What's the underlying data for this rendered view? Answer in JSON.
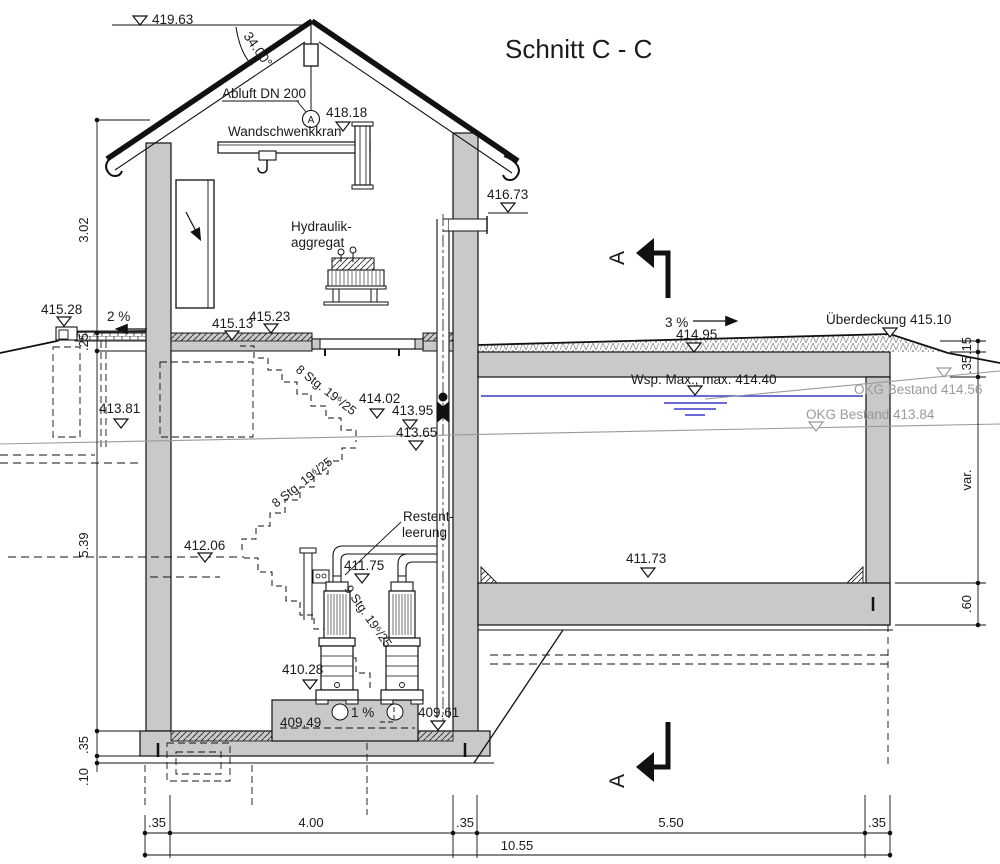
{
  "title": "Schnitt C - C",
  "section_marker": "A",
  "roof": {
    "ridge_level": "419.63",
    "angle": "34.00°",
    "vent_label": "Abluft DN 200",
    "vent_symbol": "A",
    "crane_level": "418.18",
    "crane_label": "Wandschwenkkran"
  },
  "room": {
    "hydraulic1": "Hydraulik-",
    "hydraulic2": "aggregat",
    "pipe_level": "416.73"
  },
  "left": {
    "ext_level": "415.28",
    "slope": "2 %",
    "floor_level": "415.13",
    "cover_level": "415.23",
    "drain_level": "413.81"
  },
  "stairs": {
    "flight1": "8 Stg. 19⁶/25",
    "flight2": "8 Stg. 19⁶/25",
    "flight3": "9 Stg. 19⁶/25",
    "top_level": "414.02",
    "mid_level": "413.95",
    "landing_level": "413.65",
    "lower_landing_level": "412.06"
  },
  "basin": {
    "slope": "3 %",
    "ground_level": "414.95",
    "cover_label": "Überdeckung 415.10",
    "max_water_label": "Wsp. Max., max. 414.40",
    "okg_upper": "OKG Bestand 414.56",
    "okg_lower": "OKG Bestand 413.84",
    "floor_level": "411.73"
  },
  "pumps": {
    "drain_label1": "Restent-",
    "drain_label2": "leerung",
    "pipe_level": "411.75",
    "pedestal_level": "410.28",
    "floor_level": "409.49",
    "slope": "1 %",
    "sump_level": "409.61"
  },
  "dims": {
    "bottom": [
      ".35",
      "4.00",
      ".35",
      "5.50",
      ".35"
    ],
    "total": "10.55",
    "left": [
      "3.02",
      ".25",
      "5.39",
      ".35",
      ".10"
    ],
    "right": [
      ".15",
      ".35",
      "var.",
      ".60"
    ]
  }
}
